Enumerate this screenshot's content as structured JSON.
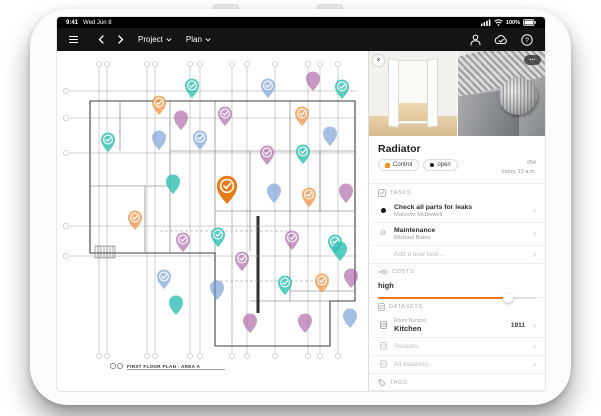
{
  "status_bar": {
    "time": "9:41",
    "date": "Wed Jun 8",
    "battery_pct": "100%"
  },
  "toolbar": {
    "project_label": "Project",
    "plan_label": "Plan"
  },
  "icons": {
    "close": "×",
    "more": "•••",
    "question": "?",
    "gear": "⚙",
    "chevron": "›",
    "plus": "+"
  },
  "plan": {
    "title": "FIRST FLOOR PLAN - AREA A",
    "colors": {
      "teal": "#2FBFB2",
      "purple": "#A75BA0",
      "blue": "#6D97D4",
      "orange": "#F0994E",
      "selected": "#E87A12"
    },
    "opacity": {
      "teal": 0.8,
      "purple": 0.62,
      "blue": 0.62,
      "orange": 0.78,
      "selected": 1
    },
    "pins": [
      {
        "x": 135,
        "y": 47,
        "c": "teal",
        "k": 1
      },
      {
        "x": 102,
        "y": 64,
        "c": "orange",
        "k": 1
      },
      {
        "x": 256,
        "y": 40,
        "c": "purple",
        "k": 0
      },
      {
        "x": 211,
        "y": 47,
        "c": "blue",
        "k": 1
      },
      {
        "x": 285,
        "y": 48,
        "c": "teal",
        "k": 1
      },
      {
        "x": 124,
        "y": 79,
        "c": "purple",
        "k": 0
      },
      {
        "x": 168,
        "y": 75,
        "c": "purple",
        "k": 1
      },
      {
        "x": 245,
        "y": 75,
        "c": "orange",
        "k": 1
      },
      {
        "x": 51,
        "y": 101,
        "c": "teal",
        "k": 1
      },
      {
        "x": 102,
        "y": 99,
        "c": "blue",
        "k": 0
      },
      {
        "x": 143,
        "y": 99,
        "c": "blue",
        "k": 1
      },
      {
        "x": 210,
        "y": 114,
        "c": "purple",
        "k": 1
      },
      {
        "x": 246,
        "y": 113,
        "c": "teal",
        "k": 1
      },
      {
        "x": 273,
        "y": 95,
        "c": "blue",
        "k": 0
      },
      {
        "x": 116,
        "y": 143,
        "c": "teal",
        "k": 0
      },
      {
        "x": 217,
        "y": 152,
        "c": "blue",
        "k": 0
      },
      {
        "x": 252,
        "y": 156,
        "c": "orange",
        "k": 1
      },
      {
        "x": 289,
        "y": 152,
        "c": "purple",
        "k": 0
      },
      {
        "x": 78,
        "y": 179,
        "c": "orange",
        "k": 1
      },
      {
        "x": 126,
        "y": 201,
        "c": "purple",
        "k": 1
      },
      {
        "x": 161,
        "y": 196,
        "c": "teal",
        "k": 1
      },
      {
        "x": 185,
        "y": 220,
        "c": "purple",
        "k": 1
      },
      {
        "x": 235,
        "y": 199,
        "c": "purple",
        "k": 1
      },
      {
        "x": 278,
        "y": 203,
        "c": "teal",
        "k": 1
      },
      {
        "x": 283,
        "y": 210,
        "c": "teal",
        "k": 0
      },
      {
        "x": 107,
        "y": 238,
        "c": "blue",
        "k": 1
      },
      {
        "x": 228,
        "y": 244,
        "c": "teal",
        "k": 1
      },
      {
        "x": 265,
        "y": 242,
        "c": "orange",
        "k": 1
      },
      {
        "x": 294,
        "y": 237,
        "c": "purple",
        "k": 0
      },
      {
        "x": 160,
        "y": 249,
        "c": "blue",
        "k": 0
      },
      {
        "x": 119,
        "y": 264,
        "c": "teal",
        "k": 0
      },
      {
        "x": 193,
        "y": 282,
        "c": "purple",
        "k": 0
      },
      {
        "x": 248,
        "y": 282,
        "c": "purple",
        "k": 0
      },
      {
        "x": 293,
        "y": 277,
        "c": "blue",
        "k": 0
      },
      {
        "x": 170,
        "y": 153,
        "c": "selected",
        "k": 1,
        "sel": 1
      }
    ]
  },
  "panel": {
    "header": {
      "title": "Radiator",
      "tag_control": "Control",
      "tag_open": "open",
      "control_color": "#F5941E",
      "id": "#54",
      "time": "today, 12 a.m."
    },
    "tasks": {
      "heading": "TASKS",
      "items": [
        {
          "title": "Check all parts for leaks",
          "assignee": "Malcolm McDowell"
        },
        {
          "title": "Maintenance",
          "assignee": "Michael Bates"
        }
      ],
      "add_placeholder": "Add a new task .."
    },
    "costs": {
      "heading": "COSTS",
      "level_label": "high",
      "slider_percent": 82,
      "slider_color": "#F4731C"
    },
    "datasets": {
      "heading": "DATASETS",
      "room_label": "Room Number",
      "room_value": "Kitchen",
      "room_number": "1911",
      "sockets_label": "Sockets..",
      "all_label": "All datasets.."
    },
    "tags": {
      "heading": "TAGS"
    },
    "note": {
      "placeholder": "Add a note .."
    }
  }
}
